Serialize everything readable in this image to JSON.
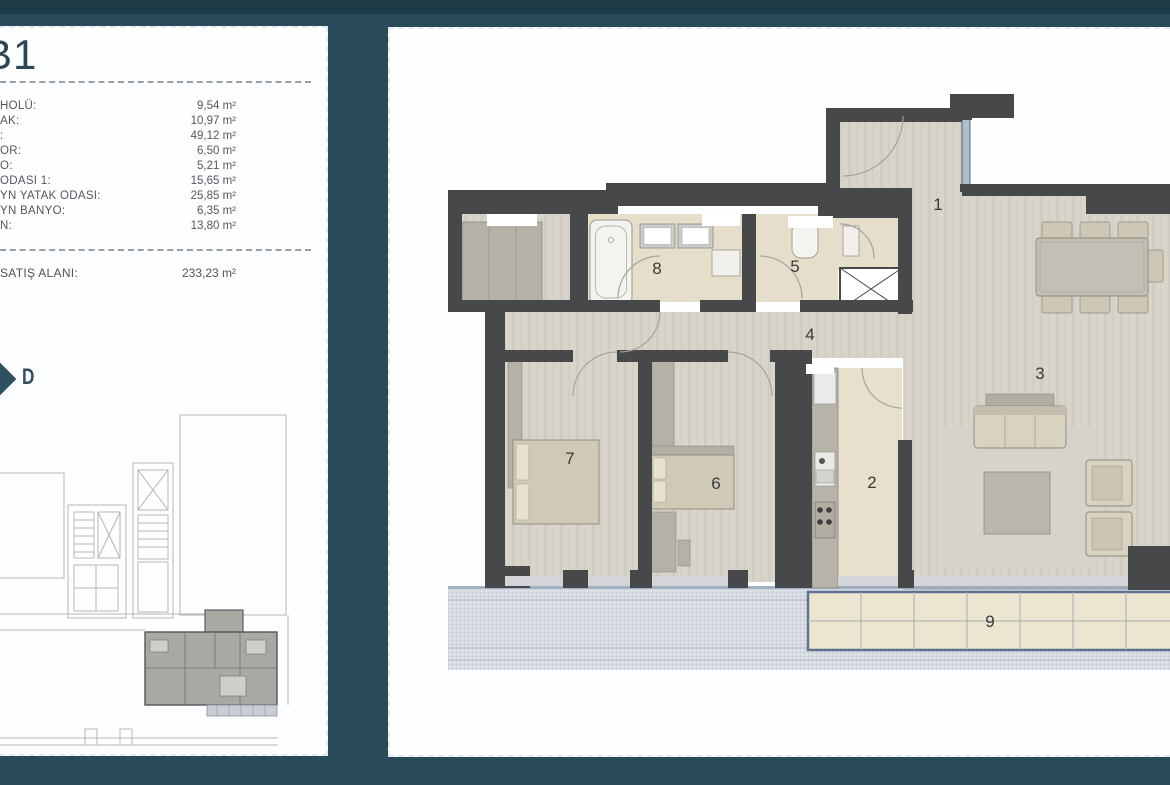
{
  "page": {
    "background": "#294b59",
    "top_strip": "#1e3b48",
    "card_background": "#fdfeff",
    "wall_color": "#474849",
    "wood_floor_color": "#d8d4ca",
    "bath_floor_color": "#e4decb",
    "furniture_beige": "#d8d3c1",
    "furniture_gray": "#b5b1a7",
    "terrace_tile_color": "#ece5d0",
    "terrace_border_color": "#5e7190",
    "accent_text_color": "#2c4656"
  },
  "unit_card": {
    "title": "B1",
    "direction_marker": "D",
    "rows": [
      {
        "label": "HOLÜ:",
        "value": "9,54 m²"
      },
      {
        "label": "AK:",
        "value": "10,97 m²"
      },
      {
        "label": ":",
        "value": "49,12 m²"
      },
      {
        "label": "OR:",
        "value": "6,50 m²"
      },
      {
        "label": "O:",
        "value": "5,21 m²"
      },
      {
        "label": "ODASI 1:",
        "value": "15,65 m²"
      },
      {
        "label": "YN YATAK ODASI:",
        "value": "25,85 m²"
      },
      {
        "label": "YN BANYO:",
        "value": "6,35 m²"
      },
      {
        "label": "N:",
        "value": "13,80 m²"
      }
    ],
    "total": {
      "label": "SATIŞ ALANI:",
      "value": "233,23 m²"
    }
  },
  "floor_plan": {
    "room_numbers": [
      "1",
      "2",
      "3",
      "4",
      "5",
      "6",
      "7",
      "8",
      "9"
    ]
  }
}
